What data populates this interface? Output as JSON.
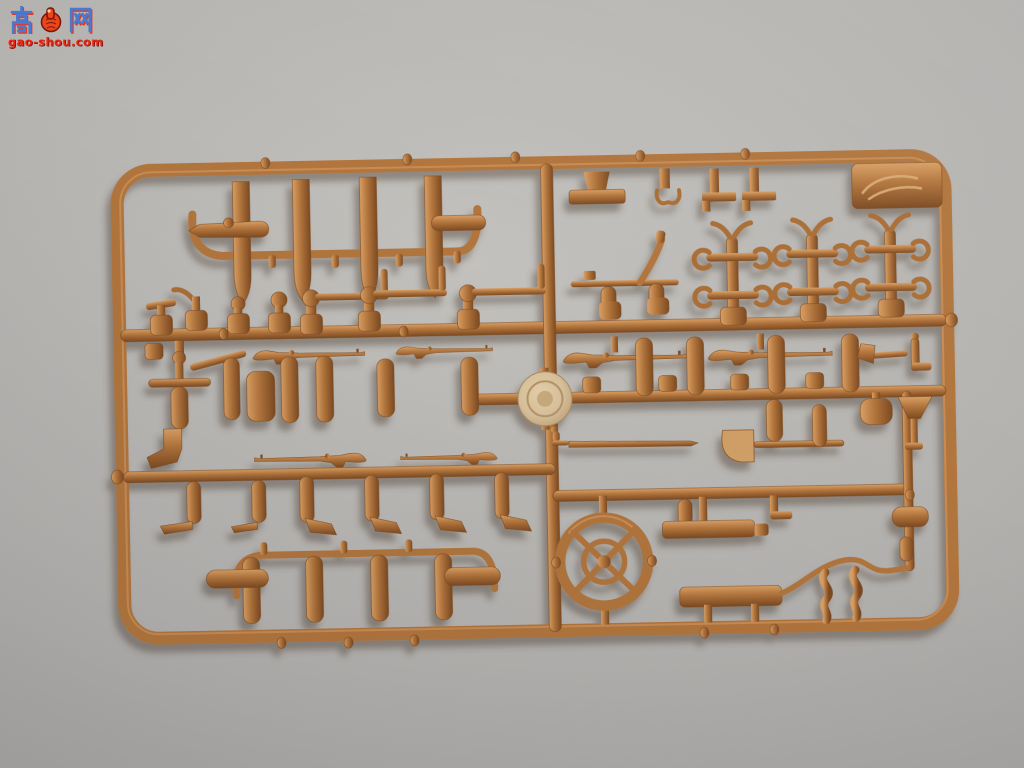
{
  "scene": {
    "type": "photograph",
    "subject": "tan injection-molded model-kit sprue (parts tree) with military figure accessories, lying on a plain gray surface",
    "plastic_color_name": "tan-brown",
    "background_name": "light gray"
  },
  "watermark": {
    "char_left": "高",
    "char_right": "网",
    "icon": "thumbs-up-badge-icon",
    "url": "gao-shou.com"
  },
  "parts_inventory": [
    "rifle x6",
    "long barrel cylinder x4",
    "spoked wheel x1",
    "round lid disc x1",
    "shovel x1",
    "pickaxe rack x3",
    "machine-gun on post x3",
    "canteen pod x4",
    "entrenching tool x6",
    "sword x1",
    "bench x1",
    "hanging bracket x4",
    "s-hook x2",
    "hatchet x1",
    "funnel x1",
    "assorted cylinders, pads and pegs"
  ],
  "colors": {
    "bg_center": "#c3c1bd",
    "bg_mid": "#b4b2af",
    "bg_edge": "#a2a09f",
    "bg_corner": "#919093",
    "sprue": "#b1743c",
    "sprue_light": "#d89f64",
    "sprue_dark": "#7c4a21",
    "sprue_deep": "#8a5526",
    "disc_light": "#e4cfa9",
    "disc_mid": "#d7c09a",
    "disc_edge": "#bda178",
    "shadow": "#4d4136",
    "wm_blue": "#4a79cf",
    "wm_red": "#e02818",
    "wm_icon": "#e8481e"
  }
}
